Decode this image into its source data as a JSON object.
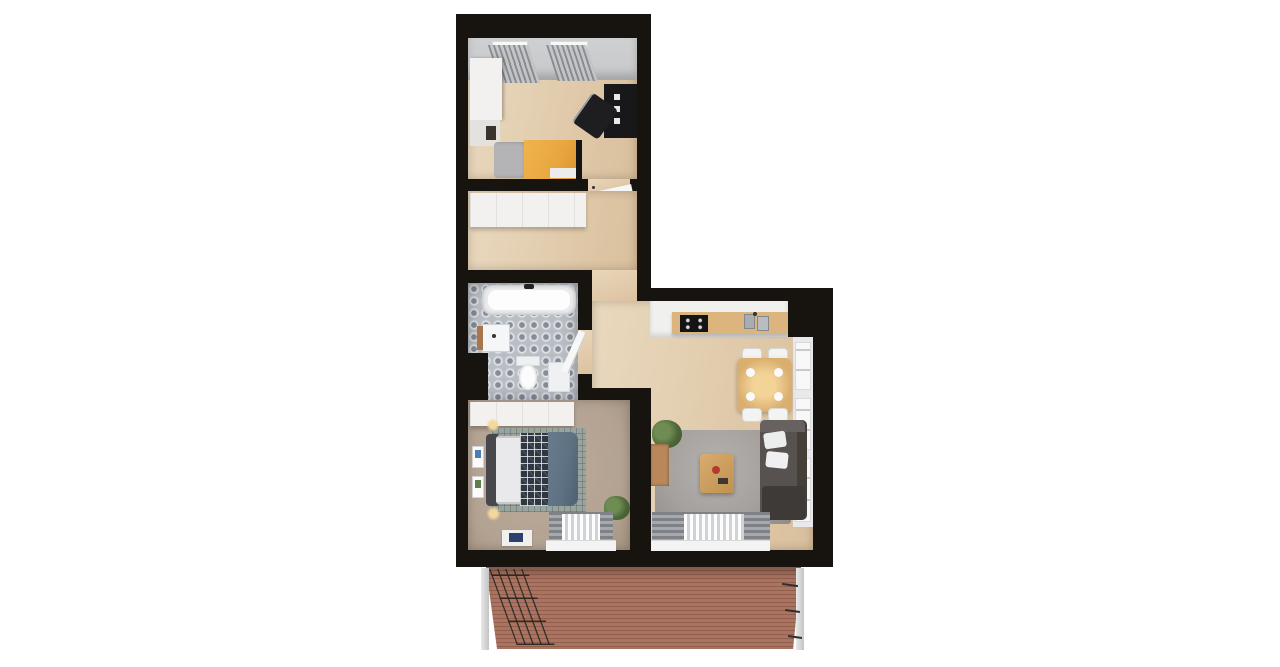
{
  "scene": {
    "type": "3d-apartment-floor-plan-render",
    "background": "#ffffff",
    "rooms": [
      {
        "id": "office-bedroom",
        "furniture": [
          "wardrobe",
          "shelf-unit",
          "gray-cushion-seat",
          "yellow-daybed",
          "black-desk",
          "office-chair",
          "two-windows-with-curtains"
        ]
      },
      {
        "id": "hallway",
        "furniture": [
          "built-in-wardrobe",
          "open-door"
        ]
      },
      {
        "id": "bathroom",
        "furniture": [
          "bathtub",
          "washbasin-with-wood-shelf",
          "toilet",
          "small-cabinet",
          "patterned-tile-floor",
          "open-door"
        ]
      },
      {
        "id": "bedroom",
        "furniture": [
          "built-in-wardrobe",
          "double-bed",
          "white-pillows",
          "plaid-blanket",
          "blue-duvet",
          "grid-rug",
          "bedside-lamps",
          "wall-art-frames",
          "potted-plant",
          "floor-mat-with-art",
          "window-with-curtains"
        ]
      },
      {
        "id": "living-room-kitchen",
        "furniture": [
          "kitchen-counter",
          "cooktop",
          "double-sink",
          "dining-table",
          "four-chairs",
          "plates",
          "area-rug",
          "coffee-table",
          "corner-sofa",
          "sofa-cushions",
          "potted-plant",
          "wood-sideboard",
          "side-windows",
          "window-with-curtains"
        ]
      },
      {
        "id": "balcony",
        "furniture": [
          "wood-decking",
          "railing-left",
          "railing-right",
          "corner-posts"
        ]
      }
    ]
  },
  "palette": {
    "wall": "#17140f",
    "floor_wood_light": "#ead9bf",
    "floor_wood_dark": "#d9bf9c",
    "bedroom_carpet": "#b3a292",
    "bathroom_tile": "#b9bec5",
    "tile_motif": "#868c97",
    "balcony_deck": "#aa7462",
    "deck_stripe": "#935f4c",
    "accent_yellow": "#e9a63f",
    "sofa_gray": "#57524f",
    "duvet_blue": "#5e7284",
    "plaid_navy": "#2f3742",
    "rug_gray": "#a5a19e",
    "rug_bed_grid": "#9aa49e",
    "counter_wood": "#dcb57e",
    "table_wood": "#d9ae6f",
    "white_furniture": "#f2f1ef",
    "window_gray": "#c7c8ca",
    "plant_green": "#4c6637"
  }
}
